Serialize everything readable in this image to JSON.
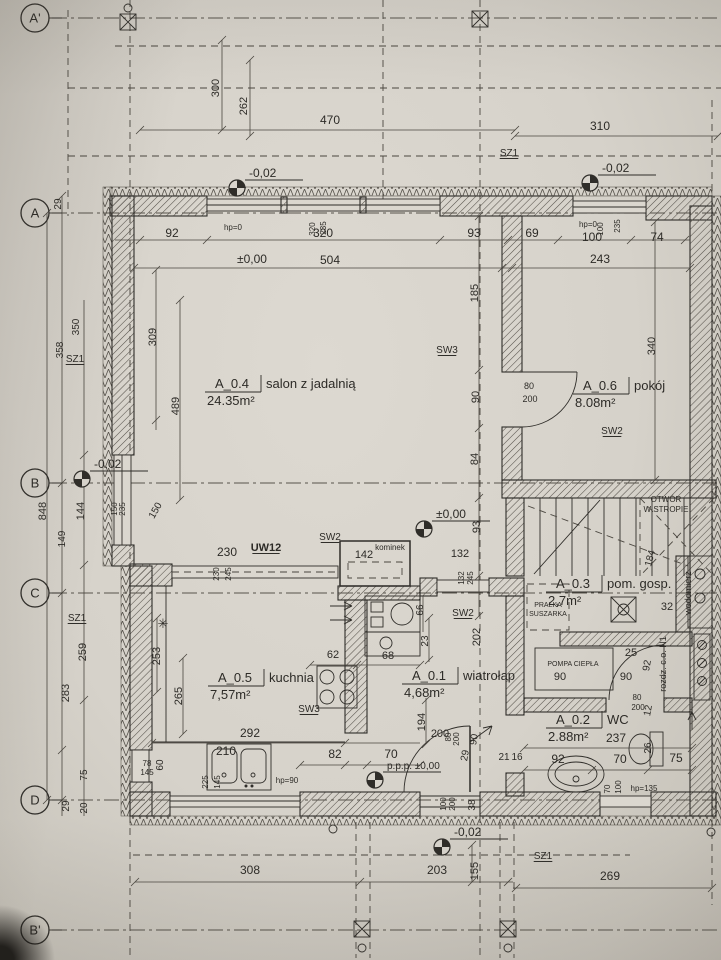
{
  "plan": {
    "colors": {
      "paper": "#d9d5cd",
      "ink": "#2f2d29",
      "dim_line": "#4a463f"
    },
    "grid_axes": [
      {
        "label": "A'",
        "y": 18
      },
      {
        "label": "A",
        "y": 213
      },
      {
        "label": "B",
        "y": 483
      },
      {
        "label": "C",
        "y": 593
      },
      {
        "label": "D",
        "y": 800
      },
      {
        "label": "B'",
        "y": 930
      }
    ],
    "level_markers": [
      {
        "t": "-0,02",
        "x": 237,
        "y": 188
      },
      {
        "t": "-0,02",
        "x": 590,
        "y": 183
      },
      {
        "t": "-0,02",
        "x": 82,
        "y": 479
      },
      {
        "t": "±0,00",
        "x": 424,
        "y": 529
      },
      {
        "t": "p.p.p. ±0,00",
        "x": 375,
        "y": 780,
        "s": 10
      },
      {
        "t": "-0,02",
        "x": 442,
        "y": 847
      }
    ],
    "rooms": [
      {
        "id": "A_0.4",
        "name": "salon z jadalnią",
        "area": "24.35m²",
        "x": 215,
        "y": 388
      },
      {
        "id": "A_0.6",
        "name": "pokój",
        "area": "8.08m²",
        "x": 583,
        "y": 390
      },
      {
        "id": "A_0.5",
        "name": "kuchnia",
        "area": "7,57m²",
        "x": 218,
        "y": 682
      },
      {
        "id": "A_0.1",
        "name": "wiatrołap",
        "area": "4,68m²",
        "x": 412,
        "y": 680
      },
      {
        "id": "A_0.3",
        "name": "pom. gosp.",
        "area": "2,7m²",
        "x": 556,
        "y": 588
      },
      {
        "id": "A_0.2",
        "name": "WC",
        "area": "2.88m²",
        "x": 556,
        "y": 724
      }
    ],
    "labels": [
      {
        "t": "29",
        "x": 61,
        "y": 204,
        "r": -90,
        "s": 10
      },
      {
        "t": "300",
        "x": 219,
        "y": 88,
        "r": -90
      },
      {
        "t": "262",
        "x": 247,
        "y": 106,
        "r": -90
      },
      {
        "t": "470",
        "x": 330,
        "y": 124,
        "s": 12
      },
      {
        "t": "310",
        "x": 600,
        "y": 130,
        "s": 12
      },
      {
        "t": "SZ1",
        "x": 509,
        "y": 156,
        "s": 10,
        "u": 1
      },
      {
        "t": "92",
        "x": 172,
        "y": 237,
        "s": 12
      },
      {
        "t": "hp=0",
        "x": 233,
        "y": 230,
        "s": 8
      },
      {
        "t": "320",
        "x": 315,
        "y": 229,
        "r": -90,
        "s": 8
      },
      {
        "t": "235",
        "x": 326,
        "y": 228,
        "r": -90,
        "s": 8
      },
      {
        "t": "320",
        "x": 323,
        "y": 237,
        "s": 12
      },
      {
        "t": "±0,00",
        "x": 252,
        "y": 263,
        "s": 12
      },
      {
        "t": "504",
        "x": 330,
        "y": 264,
        "s": 12
      },
      {
        "t": "93",
        "x": 474,
        "y": 237,
        "s": 12
      },
      {
        "t": "69",
        "x": 532,
        "y": 237,
        "s": 12
      },
      {
        "t": "hp=0",
        "x": 588,
        "y": 227,
        "s": 8
      },
      {
        "t": "100",
        "x": 603,
        "y": 229,
        "r": -90,
        "s": 8
      },
      {
        "t": "235",
        "x": 620,
        "y": 226,
        "r": -90,
        "s": 8
      },
      {
        "t": "100",
        "x": 592,
        "y": 241,
        "s": 12
      },
      {
        "t": "74",
        "x": 657,
        "y": 241,
        "s": 12
      },
      {
        "t": "243",
        "x": 600,
        "y": 263,
        "s": 12
      },
      {
        "t": "185",
        "x": 478,
        "y": 293,
        "r": -90
      },
      {
        "t": "340",
        "x": 655,
        "y": 346,
        "r": -90
      },
      {
        "t": "350",
        "x": 79,
        "y": 327,
        "r": -90,
        "s": 10
      },
      {
        "t": "358",
        "x": 63,
        "y": 350,
        "r": -90,
        "s": 10
      },
      {
        "t": "SZ1",
        "x": 75,
        "y": 362,
        "s": 10,
        "u": 1
      },
      {
        "t": "309",
        "x": 156,
        "y": 337,
        "r": -90
      },
      {
        "t": "489",
        "x": 179,
        "y": 406,
        "r": -90
      },
      {
        "t": "90",
        "x": 479,
        "y": 397,
        "r": -90
      },
      {
        "t": "SW3",
        "x": 447,
        "y": 353,
        "s": 10,
        "u": 1
      },
      {
        "t": "80",
        "x": 529,
        "y": 389,
        "s": 9
      },
      {
        "t": "200",
        "x": 530,
        "y": 402,
        "s": 9
      },
      {
        "t": "SW2",
        "x": 612,
        "y": 434,
        "s": 10,
        "u": 1
      },
      {
        "t": "848",
        "x": 46,
        "y": 511,
        "r": -90
      },
      {
        "t": "144",
        "x": 84,
        "y": 511,
        "r": -90
      },
      {
        "t": "149",
        "x": 65,
        "y": 539,
        "r": -90,
        "s": 10
      },
      {
        "t": "150",
        "x": 117,
        "y": 509,
        "r": -90,
        "s": 8
      },
      {
        "t": "235",
        "x": 125,
        "y": 509,
        "r": -90,
        "s": 8
      },
      {
        "t": "150",
        "x": 158,
        "y": 512,
        "r": -60,
        "s": 10
      },
      {
        "t": "84",
        "x": 478,
        "y": 459,
        "r": -90
      },
      {
        "t": "93",
        "x": 480,
        "y": 527,
        "r": -90
      },
      {
        "t": "132",
        "x": 460,
        "y": 557
      },
      {
        "t": "132",
        "x": 464,
        "y": 578,
        "r": -90,
        "s": 8
      },
      {
        "t": "245",
        "x": 473,
        "y": 578,
        "r": -90,
        "s": 8
      },
      {
        "t": "66",
        "x": 423,
        "y": 610,
        "r": -90,
        "s": 10
      },
      {
        "t": "230",
        "x": 227,
        "y": 556,
        "s": 12
      },
      {
        "t": "UW12",
        "x": 266,
        "y": 551,
        "b": 1,
        "u": 1
      },
      {
        "t": "230",
        "x": 219,
        "y": 574,
        "r": -90,
        "s": 8
      },
      {
        "t": "245",
        "x": 231,
        "y": 574,
        "r": -90,
        "s": 8
      },
      {
        "t": "SW2",
        "x": 330,
        "y": 540,
        "s": 10,
        "u": 1
      },
      {
        "t": "142",
        "x": 364,
        "y": 558
      },
      {
        "t": "kominek",
        "x": 390,
        "y": 550,
        "s": 8
      },
      {
        "t": "OTWÓR",
        "x": 666,
        "y": 502,
        "s": 8
      },
      {
        "t": "W STROPIE",
        "x": 666,
        "y": 512,
        "s": 8
      },
      {
        "t": "184",
        "x": 653,
        "y": 559,
        "r": -75,
        "s": 10
      },
      {
        "t": "SZ1",
        "x": 77,
        "y": 621,
        "s": 10,
        "u": 1
      },
      {
        "t": "259",
        "x": 86,
        "y": 652,
        "r": -90
      },
      {
        "t": "283",
        "x": 69,
        "y": 693,
        "r": -90
      },
      {
        "t": "253",
        "x": 160,
        "y": 656,
        "r": -90
      },
      {
        "t": "265",
        "x": 182,
        "y": 696,
        "r": -90
      },
      {
        "t": "✳",
        "x": 163,
        "y": 628,
        "s": 13
      },
      {
        "t": "62",
        "x": 333,
        "y": 658
      },
      {
        "t": "68",
        "x": 388,
        "y": 659
      },
      {
        "t": "SW3",
        "x": 309,
        "y": 712,
        "s": 10,
        "u": 1
      },
      {
        "t": "292",
        "x": 250,
        "y": 737,
        "s": 12
      },
      {
        "t": "210",
        "x": 226,
        "y": 755,
        "s": 12
      },
      {
        "t": "82",
        "x": 335,
        "y": 758,
        "s": 12
      },
      {
        "t": "70",
        "x": 391,
        "y": 758,
        "s": 12
      },
      {
        "t": "78",
        "x": 147,
        "y": 766,
        "s": 8
      },
      {
        "t": "145",
        "x": 147,
        "y": 775,
        "s": 8
      },
      {
        "t": "60",
        "x": 163,
        "y": 765,
        "r": -90,
        "s": 10
      },
      {
        "t": "225",
        "x": 208,
        "y": 782,
        "r": -90,
        "s": 8
      },
      {
        "t": "145",
        "x": 220,
        "y": 782,
        "r": -90,
        "s": 8
      },
      {
        "t": "hp=90",
        "x": 287,
        "y": 783,
        "s": 8
      },
      {
        "t": "23",
        "x": 428,
        "y": 641,
        "r": -90,
        "s": 10
      },
      {
        "t": "202",
        "x": 480,
        "y": 637,
        "r": -90
      },
      {
        "t": "SW2",
        "x": 463,
        "y": 616,
        "s": 10,
        "u": 1
      },
      {
        "t": "194",
        "x": 425,
        "y": 722,
        "r": -90
      },
      {
        "t": "200",
        "x": 440,
        "y": 737
      },
      {
        "t": "90",
        "x": 477,
        "y": 740,
        "r": -80,
        "s": 10
      },
      {
        "t": "29",
        "x": 468,
        "y": 756,
        "r": -80,
        "s": 10
      },
      {
        "t": "80",
        "x": 451,
        "y": 737,
        "r": -90,
        "s": 8
      },
      {
        "t": "200",
        "x": 459,
        "y": 739,
        "r": -90,
        "s": 8
      },
      {
        "t": "21",
        "x": 504,
        "y": 760,
        "s": 10
      },
      {
        "t": "16",
        "x": 517,
        "y": 760,
        "s": 10
      },
      {
        "t": "100",
        "x": 446,
        "y": 804,
        "r": -90,
        "s": 8
      },
      {
        "t": "200",
        "x": 455,
        "y": 804,
        "r": -90,
        "s": 8
      },
      {
        "t": "38",
        "x": 475,
        "y": 805,
        "r": -90,
        "s": 10
      },
      {
        "t": "PRALKA",
        "x": 548,
        "y": 607,
        "s": 7
      },
      {
        "t": "SUSZARKA",
        "x": 548,
        "y": 616,
        "s": 7
      },
      {
        "t": "32",
        "x": 667,
        "y": 610
      },
      {
        "t": "wodomierz",
        "x": 691,
        "y": 593,
        "r": -90,
        "s": 9
      },
      {
        "t": "POMPA CIEPŁA",
        "x": 573,
        "y": 666,
        "s": 7
      },
      {
        "t": "90",
        "x": 560,
        "y": 680
      },
      {
        "t": "25",
        "x": 631,
        "y": 656
      },
      {
        "t": "90",
        "x": 626,
        "y": 680
      },
      {
        "t": "92",
        "x": 650,
        "y": 666,
        "r": -80,
        "s": 10
      },
      {
        "t": "rozdz. c.o. N1",
        "x": 666,
        "y": 664,
        "r": -90,
        "s": 9
      },
      {
        "t": "12",
        "x": 651,
        "y": 711,
        "r": -80,
        "s": 10
      },
      {
        "t": "80",
        "x": 637,
        "y": 700,
        "s": 8
      },
      {
        "t": "200",
        "x": 638,
        "y": 710,
        "s": 8
      },
      {
        "t": "237",
        "x": 616,
        "y": 742,
        "s": 12
      },
      {
        "t": "92",
        "x": 558,
        "y": 763,
        "s": 12
      },
      {
        "t": "70",
        "x": 620,
        "y": 763,
        "s": 12
      },
      {
        "t": "75",
        "x": 676,
        "y": 762,
        "s": 12
      },
      {
        "t": "26",
        "x": 651,
        "y": 748,
        "r": -90,
        "s": 10
      },
      {
        "t": "70",
        "x": 610,
        "y": 789,
        "r": -90,
        "s": 8
      },
      {
        "t": "100",
        "x": 621,
        "y": 787,
        "r": -90,
        "s": 8
      },
      {
        "t": "hp=135",
        "x": 644,
        "y": 791,
        "s": 8
      },
      {
        "t": "75",
        "x": 87,
        "y": 775,
        "r": -90,
        "s": 10
      },
      {
        "t": "29",
        "x": 69,
        "y": 806,
        "r": -90,
        "s": 10
      },
      {
        "t": "20",
        "x": 87,
        "y": 808,
        "r": -90,
        "s": 10
      },
      {
        "t": "308",
        "x": 250,
        "y": 874,
        "s": 12
      },
      {
        "t": "203",
        "x": 437,
        "y": 874,
        "s": 12
      },
      {
        "t": "155",
        "x": 478,
        "y": 871,
        "r": -90
      },
      {
        "t": "SZ1",
        "x": 543,
        "y": 859,
        "s": 10,
        "u": 1
      },
      {
        "t": "269",
        "x": 610,
        "y": 880,
        "s": 12
      }
    ]
  }
}
